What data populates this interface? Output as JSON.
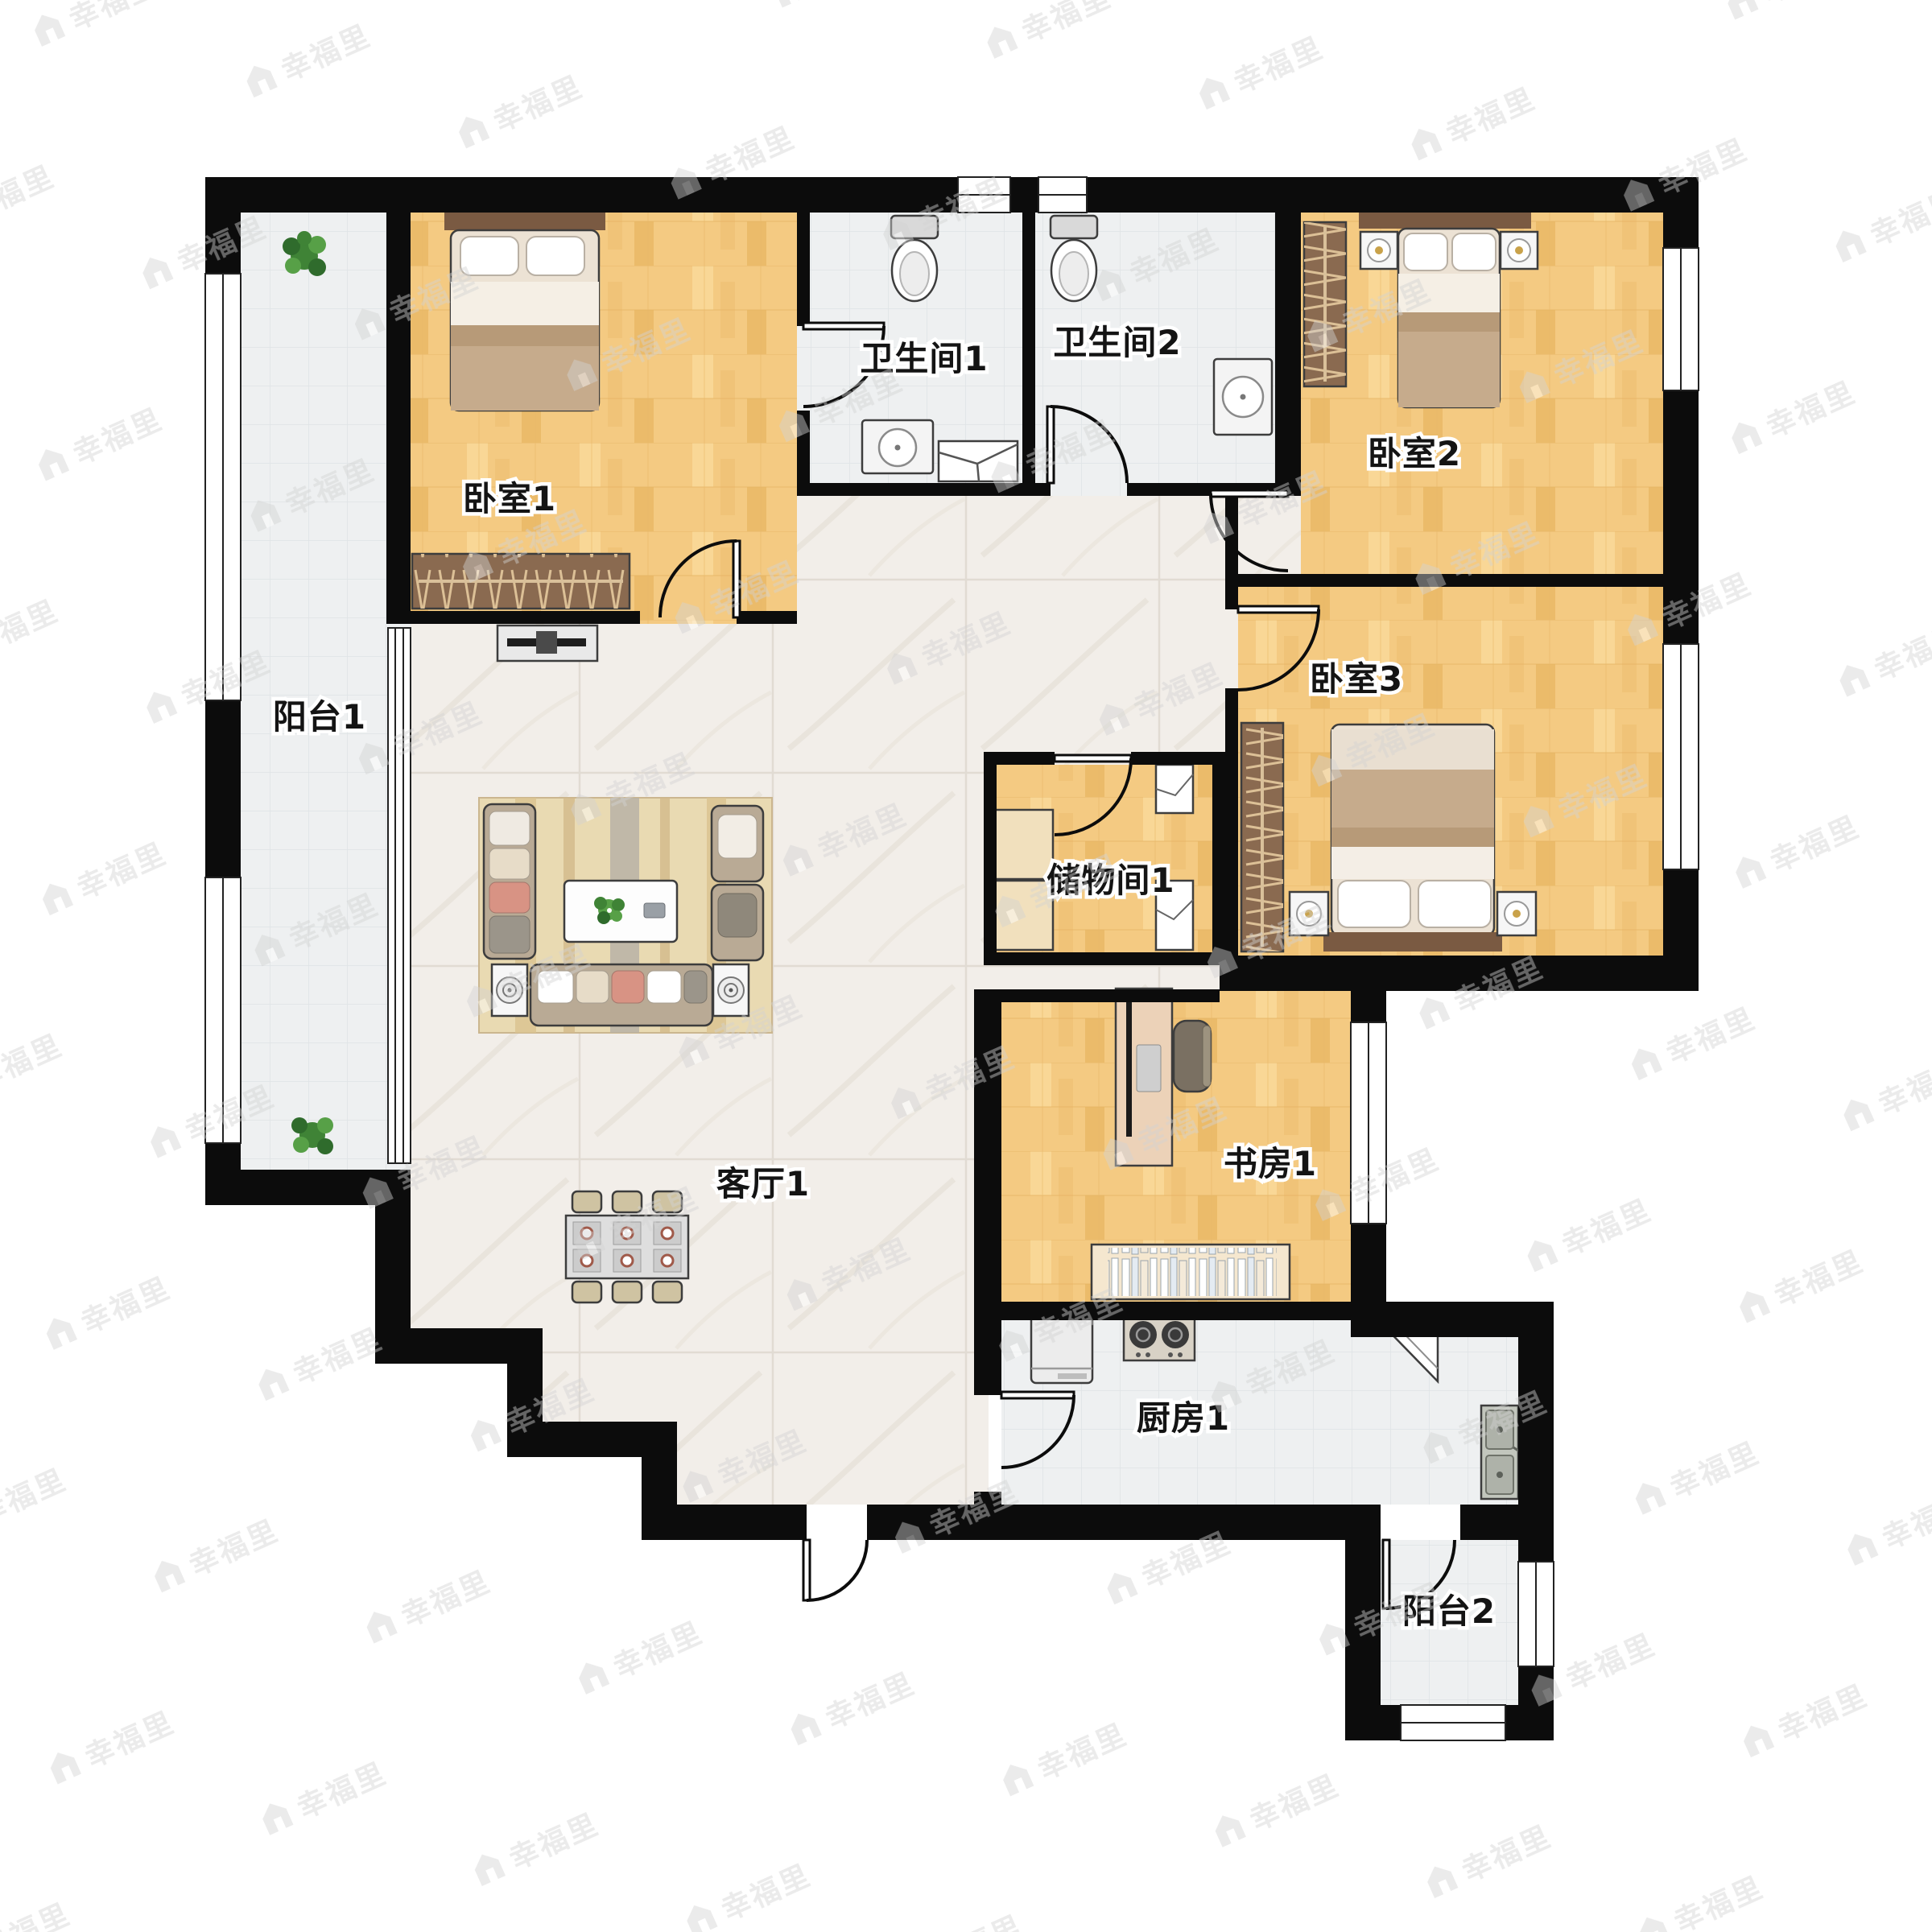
{
  "watermark": {
    "text": "幸福里",
    "icon": "house-logo-icon",
    "color": "#d2d2d2"
  },
  "rooms": [
    {
      "id": "balcony-1",
      "label": "阳台1"
    },
    {
      "id": "bedroom-1",
      "label": "卧室1"
    },
    {
      "id": "bathroom-1",
      "label": "卫生间1"
    },
    {
      "id": "bathroom-2",
      "label": "卫生间2"
    },
    {
      "id": "bedroom-2",
      "label": "卧室2"
    },
    {
      "id": "bedroom-3",
      "label": "卧室3"
    },
    {
      "id": "storage-1",
      "label": "储物间1"
    },
    {
      "id": "living-room-1",
      "label": "客厅1"
    },
    {
      "id": "study-1",
      "label": "书房1"
    },
    {
      "id": "kitchen-1",
      "label": "厨房1"
    },
    {
      "id": "balcony-2",
      "label": "阳台2"
    }
  ],
  "colors": {
    "wall": "#0c0c0c",
    "wood_floor": "#f4ca82",
    "marble_floor": "#f2eee9",
    "tile_floor": "#eef0f1",
    "furniture_wood": "#8a6a50",
    "headboard": "#7a5a42",
    "blanket": "#c6ab8c",
    "sofa": "#b9aa95",
    "rug": "#e9dab2",
    "plant": "#3f8336",
    "accent_cushion": "#d89384"
  },
  "icons": [
    "bed-icon",
    "pillow-icon",
    "wardrobe-icon",
    "nightstand-lamp-icon",
    "toilet-icon",
    "sink-icon",
    "shower-icon",
    "sofa-icon",
    "armchair-icon",
    "coffee-table-icon",
    "flower-icon",
    "speaker-table-icon",
    "rug-icon",
    "tv-console-icon",
    "dining-table-icon",
    "dining-chair-icon",
    "desk-icon",
    "monitor-icon",
    "office-chair-icon",
    "bookshelf-icon",
    "stove-icon",
    "fridge-icon",
    "kitchen-sink-icon",
    "corner-cabinet-icon",
    "storage-cabinet-icon",
    "plant-icon",
    "door-arc-icon",
    "window-icon",
    "house-logo-icon"
  ]
}
